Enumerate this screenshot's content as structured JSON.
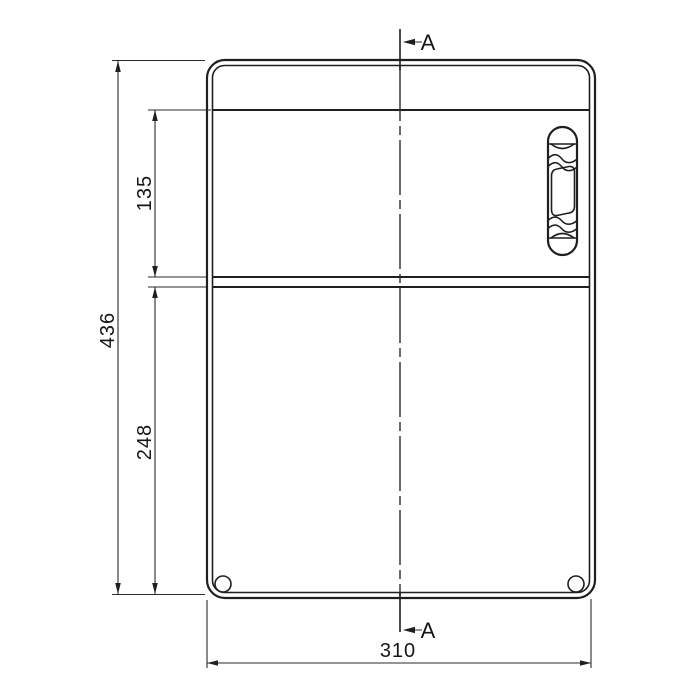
{
  "drawing": {
    "background_color": "#ffffff",
    "line_color": "#1f1f1f",
    "labels": {
      "dim_overall_height": "436",
      "dim_upper_height": "135",
      "dim_lower_height": "248",
      "dim_overall_width": "310",
      "section_marker_top": "A",
      "section_marker_bottom": "A"
    }
  }
}
